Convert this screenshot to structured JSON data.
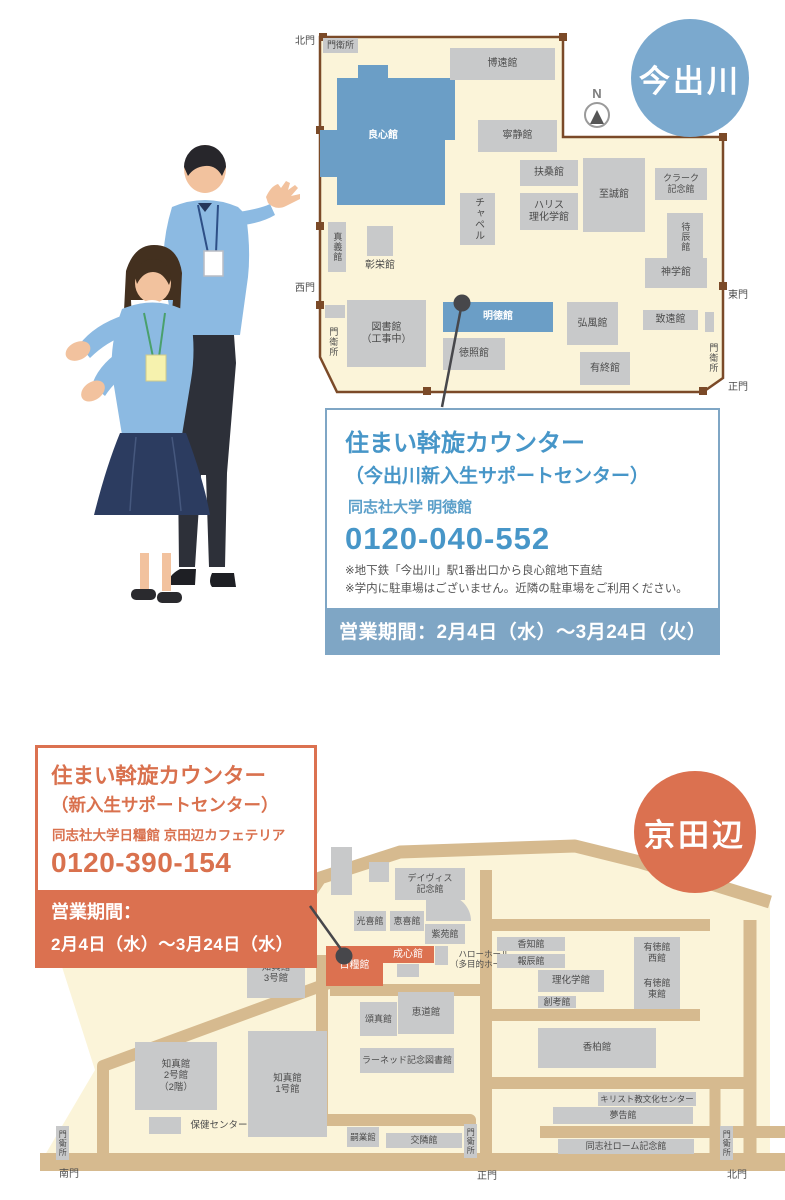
{
  "imadegawa": {
    "circle": "今出川",
    "compass": "N",
    "info": {
      "title": "住まい斡旋カウンター",
      "subtitle": "（今出川新入生サポートセンター）",
      "location": "同志社大学 明徳館",
      "phone": "0120-040-552",
      "note1": "※地下鉄「今出川」駅1番出口から良心館地下直結",
      "note2": "※学内に駐車場はございません。近隣の駐車場をご利用ください。",
      "period": "営業期間：2月4日（水）～3月24日（火）"
    },
    "buildings": [
      {
        "label": "門衛所",
        "x": 8,
        "y": 8,
        "w": 35,
        "h": 15,
        "t": "gray",
        "fs": 9
      },
      {
        "label": "博遠館",
        "x": 135,
        "y": 18,
        "w": 105,
        "h": 32,
        "t": "gray"
      },
      {
        "label": "良心館",
        "x": 38,
        "y": 98,
        "w": 60,
        "h": 16,
        "t": "textw"
      },
      {
        "label": "寧静館",
        "x": 163,
        "y": 90,
        "w": 79,
        "h": 32,
        "t": "gray"
      },
      {
        "label": "扶桑館",
        "x": 205,
        "y": 130,
        "w": 58,
        "h": 26,
        "t": "gray"
      },
      {
        "label": "ハリス\n理化学館",
        "x": 205,
        "y": 163,
        "w": 58,
        "h": 37,
        "t": "gray"
      },
      {
        "label": "至誠館",
        "x": 268,
        "y": 128,
        "w": 62,
        "h": 74,
        "t": "gray"
      },
      {
        "label": "クラーク\n記念館",
        "x": 340,
        "y": 138,
        "w": 52,
        "h": 32,
        "t": "gray",
        "fs": 9
      },
      {
        "label": "チャペル",
        "x": 145,
        "y": 163,
        "w": 35,
        "h": 52,
        "t": "gray",
        "v": true
      },
      {
        "label": "待辰館",
        "x": 352,
        "y": 183,
        "w": 36,
        "h": 47,
        "t": "gray",
        "v": true,
        "fs": 9
      },
      {
        "label": "真義館",
        "x": 13,
        "y": 192,
        "w": 18,
        "h": 50,
        "t": "gray",
        "v": true,
        "fs": 9
      },
      {
        "x": 52,
        "y": 196,
        "w": 26,
        "h": 30,
        "t": "gray"
      },
      {
        "label": "彰栄館",
        "x": 44,
        "y": 230,
        "w": 42,
        "h": 12,
        "t": "text"
      },
      {
        "label": "神学館",
        "x": 330,
        "y": 228,
        "w": 62,
        "h": 30,
        "t": "gray"
      },
      {
        "label": "図書館\n（工事中）",
        "x": 32,
        "y": 270,
        "w": 79,
        "h": 67,
        "t": "gray"
      },
      {
        "label": "明徳館",
        "x": 128,
        "y": 272,
        "w": 110,
        "h": 30,
        "t": "blue"
      },
      {
        "label": "徳照館",
        "x": 128,
        "y": 308,
        "w": 62,
        "h": 32,
        "t": "gray"
      },
      {
        "label": "弘風館",
        "x": 252,
        "y": 272,
        "w": 51,
        "h": 43,
        "t": "gray"
      },
      {
        "label": "有終館",
        "x": 265,
        "y": 322,
        "w": 50,
        "h": 33,
        "t": "gray"
      },
      {
        "label": "致遠館",
        "x": 328,
        "y": 280,
        "w": 55,
        "h": 20,
        "t": "gray"
      },
      {
        "x": 390,
        "y": 282,
        "w": 9,
        "h": 20,
        "t": "gray"
      },
      {
        "x": 10,
        "y": 275,
        "w": 20,
        "h": 13,
        "t": "gray"
      },
      {
        "label": "門衛所",
        "x": 12,
        "y": 290,
        "w": 12,
        "h": 44,
        "t": "text",
        "v": true,
        "fs": 9
      },
      {
        "label": "門衛所",
        "x": 392,
        "y": 306,
        "w": 12,
        "h": 44,
        "t": "text",
        "v": true,
        "fs": 9
      },
      {
        "label": "北門",
        "x": -22,
        "y": 6,
        "w": 24,
        "h": 12,
        "t": "text"
      },
      {
        "label": "西門",
        "x": -22,
        "y": 253,
        "w": 24,
        "h": 12,
        "t": "text"
      },
      {
        "label": "東門",
        "x": 411,
        "y": 260,
        "w": 24,
        "h": 12,
        "t": "text"
      },
      {
        "label": "正門",
        "x": 411,
        "y": 352,
        "w": 24,
        "h": 12,
        "t": "text"
      }
    ]
  },
  "kyotanabe": {
    "circle": "京田辺",
    "info": {
      "title": "住まい斡旋カウンター",
      "subtitle": "（新入生サポートセンター）",
      "location": "同志社大学日糧館 京田辺カフェテリア",
      "phone": "0120-390-154",
      "period_label": "営業期間：",
      "period": "2月4日（水）～3月24日（水）"
    },
    "buildings": [
      {
        "x": 291,
        "y": 22,
        "w": 21,
        "h": 48,
        "t": "gray"
      },
      {
        "x": 329,
        "y": 37,
        "w": 20,
        "h": 20,
        "t": "gray"
      },
      {
        "label": "デイヴィス\n記念館",
        "x": 355,
        "y": 43,
        "w": 70,
        "h": 32,
        "t": "gray",
        "fs": 9
      },
      {
        "x": 386,
        "y": 70,
        "w": 45,
        "h": 26,
        "t": "gray",
        "r": "0 26px 0 0"
      },
      {
        "label": "光喜館",
        "x": 314,
        "y": 86,
        "w": 32,
        "h": 20,
        "t": "gray",
        "fs": 9
      },
      {
        "label": "恵喜館",
        "x": 350,
        "y": 86,
        "w": 34,
        "h": 20,
        "t": "gray",
        "fs": 9
      },
      {
        "label": "紫苑館",
        "x": 385,
        "y": 99,
        "w": 40,
        "h": 20,
        "t": "gray",
        "fs": 9
      },
      {
        "x": 395,
        "y": 121,
        "w": 13,
        "h": 19,
        "t": "gray"
      },
      {
        "x": 357,
        "y": 139,
        "w": 22,
        "h": 13,
        "t": "gray"
      },
      {
        "label": "ハローホール\n（多目的ホール）",
        "x": 406,
        "y": 122,
        "w": 76,
        "h": 24,
        "t": "text",
        "fs": 8.5
      },
      {
        "label": "成心館",
        "x": 342,
        "y": 121,
        "w": 52,
        "h": 17,
        "t": "orange",
        "fs": 10
      },
      {
        "label": "日糧館",
        "x": 286,
        "y": 121,
        "w": 57,
        "h": 40,
        "t": "orange",
        "fs": 10
      },
      {
        "label": "香知館",
        "x": 457,
        "y": 112,
        "w": 68,
        "h": 14,
        "t": "gray",
        "fs": 9
      },
      {
        "label": "報辰館",
        "x": 457,
        "y": 129,
        "w": 68,
        "h": 14,
        "t": "gray",
        "fs": 9
      },
      {
        "label": "理化学館",
        "x": 498,
        "y": 145,
        "w": 66,
        "h": 22,
        "t": "gray",
        "fs": 9.5
      },
      {
        "label": "創考館",
        "x": 498,
        "y": 171,
        "w": 38,
        "h": 12,
        "t": "gray",
        "fs": 9
      },
      {
        "x": 594,
        "y": 112,
        "w": 46,
        "h": 72,
        "t": "gray"
      },
      {
        "label": "有徳館\n西館",
        "x": 594,
        "y": 116,
        "w": 46,
        "h": 24,
        "t": "text",
        "fs": 9
      },
      {
        "label": "有徳館\n東館",
        "x": 594,
        "y": 152,
        "w": 46,
        "h": 24,
        "t": "text",
        "fs": 9
      },
      {
        "label": "香柏館",
        "x": 498,
        "y": 203,
        "w": 118,
        "h": 40,
        "t": "gray",
        "fs": 9.5
      },
      {
        "label": "知真館\n3号館",
        "x": 207,
        "y": 123,
        "w": 58,
        "h": 50,
        "t": "gray",
        "fs": 9.5
      },
      {
        "label": "知真館\n2号館\n（2階）",
        "x": 95,
        "y": 217,
        "w": 82,
        "h": 68,
        "t": "gray",
        "fs": 9.5
      },
      {
        "label": "知真館\n1号館",
        "x": 208,
        "y": 206,
        "w": 79,
        "h": 106,
        "t": "gray",
        "fs": 9.5
      },
      {
        "x": 109,
        "y": 292,
        "w": 32,
        "h": 17,
        "t": "gray"
      },
      {
        "label": "保健センター",
        "x": 141,
        "y": 295,
        "w": 76,
        "h": 12,
        "t": "text",
        "fs": 9.5
      },
      {
        "label": "頌真館",
        "x": 320,
        "y": 177,
        "w": 37,
        "h": 34,
        "t": "gray",
        "fs": 9
      },
      {
        "label": "恵道館",
        "x": 358,
        "y": 167,
        "w": 56,
        "h": 42,
        "t": "gray",
        "fs": 9.5
      },
      {
        "label": "ラーネッド記念図書館",
        "x": 320,
        "y": 223,
        "w": 94,
        "h": 25,
        "t": "gray",
        "fs": 9
      },
      {
        "label": "嗣業館",
        "x": 307,
        "y": 302,
        "w": 32,
        "h": 20,
        "t": "gray",
        "fs": 8.5
      },
      {
        "label": "交隣館",
        "x": 346,
        "y": 308,
        "w": 76,
        "h": 15,
        "t": "gray",
        "fs": 9
      },
      {
        "label": "キリスト教文化センター",
        "x": 558,
        "y": 267,
        "w": 98,
        "h": 14,
        "t": "gray",
        "fs": 8.5
      },
      {
        "label": "夢告館",
        "x": 513,
        "y": 282,
        "w": 140,
        "h": 17,
        "t": "gray",
        "fs": 9
      },
      {
        "label": "同志社ローム記念館",
        "x": 518,
        "y": 314,
        "w": 136,
        "h": 15,
        "t": "gray",
        "fs": 9
      },
      {
        "label": "門衛所",
        "x": 16,
        "y": 301,
        "w": 13,
        "h": 34,
        "t": "gray",
        "v": true,
        "fs": 8
      },
      {
        "label": "門衛所",
        "x": 424,
        "y": 299,
        "w": 13,
        "h": 34,
        "t": "gray",
        "v": true,
        "fs": 8
      },
      {
        "label": "門衛所",
        "x": 680,
        "y": 301,
        "w": 13,
        "h": 34,
        "t": "gray",
        "v": true,
        "fs": 8
      },
      {
        "label": "南門",
        "x": 14,
        "y": 344,
        "w": 30,
        "h": 12,
        "t": "text"
      },
      {
        "label": "正門",
        "x": 432,
        "y": 346,
        "w": 30,
        "h": 12,
        "t": "text"
      },
      {
        "label": "北門",
        "x": 682,
        "y": 345,
        "w": 30,
        "h": 12,
        "t": "text"
      }
    ]
  }
}
